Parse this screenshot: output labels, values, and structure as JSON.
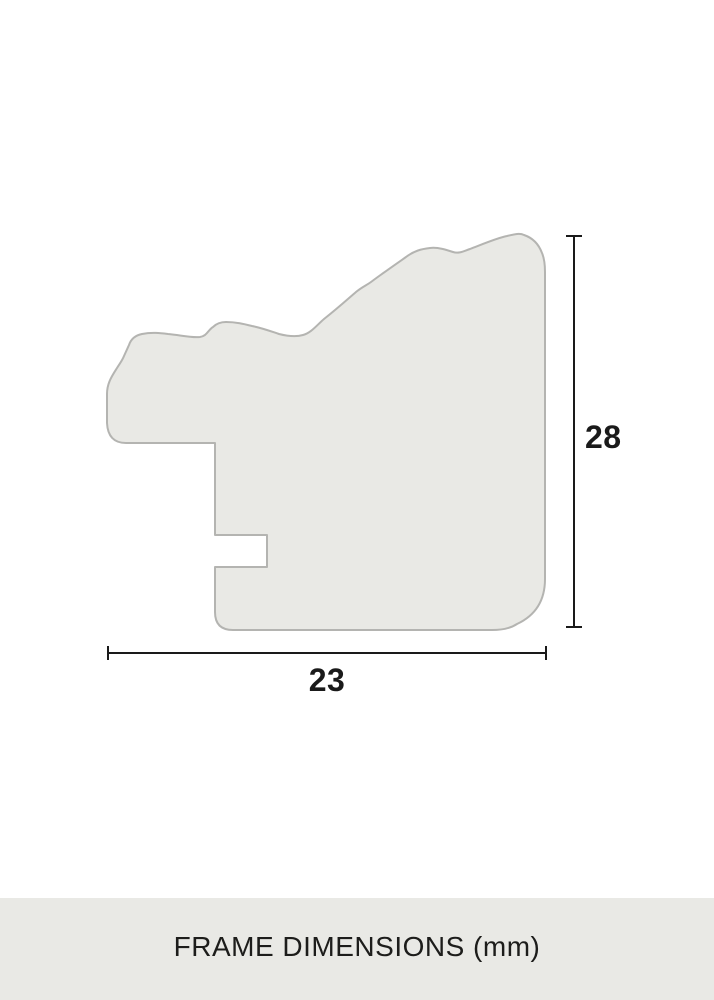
{
  "diagram": {
    "subject": "picture-frame-moulding-profile-cross-section",
    "unit": "mm",
    "height_dimension": {
      "value": "28"
    },
    "width_dimension": {
      "value": "23"
    },
    "caption": "FRAME DIMENSIONS (mm)"
  },
  "colors": {
    "background": "#ffffff",
    "profile_fill": "#e9e9e5",
    "profile_outline": "#b4b4b1",
    "dimension_line": "#1a1a1a",
    "caption_bar_background": "#e9e9e5",
    "caption_text": "#1d1d1b"
  }
}
